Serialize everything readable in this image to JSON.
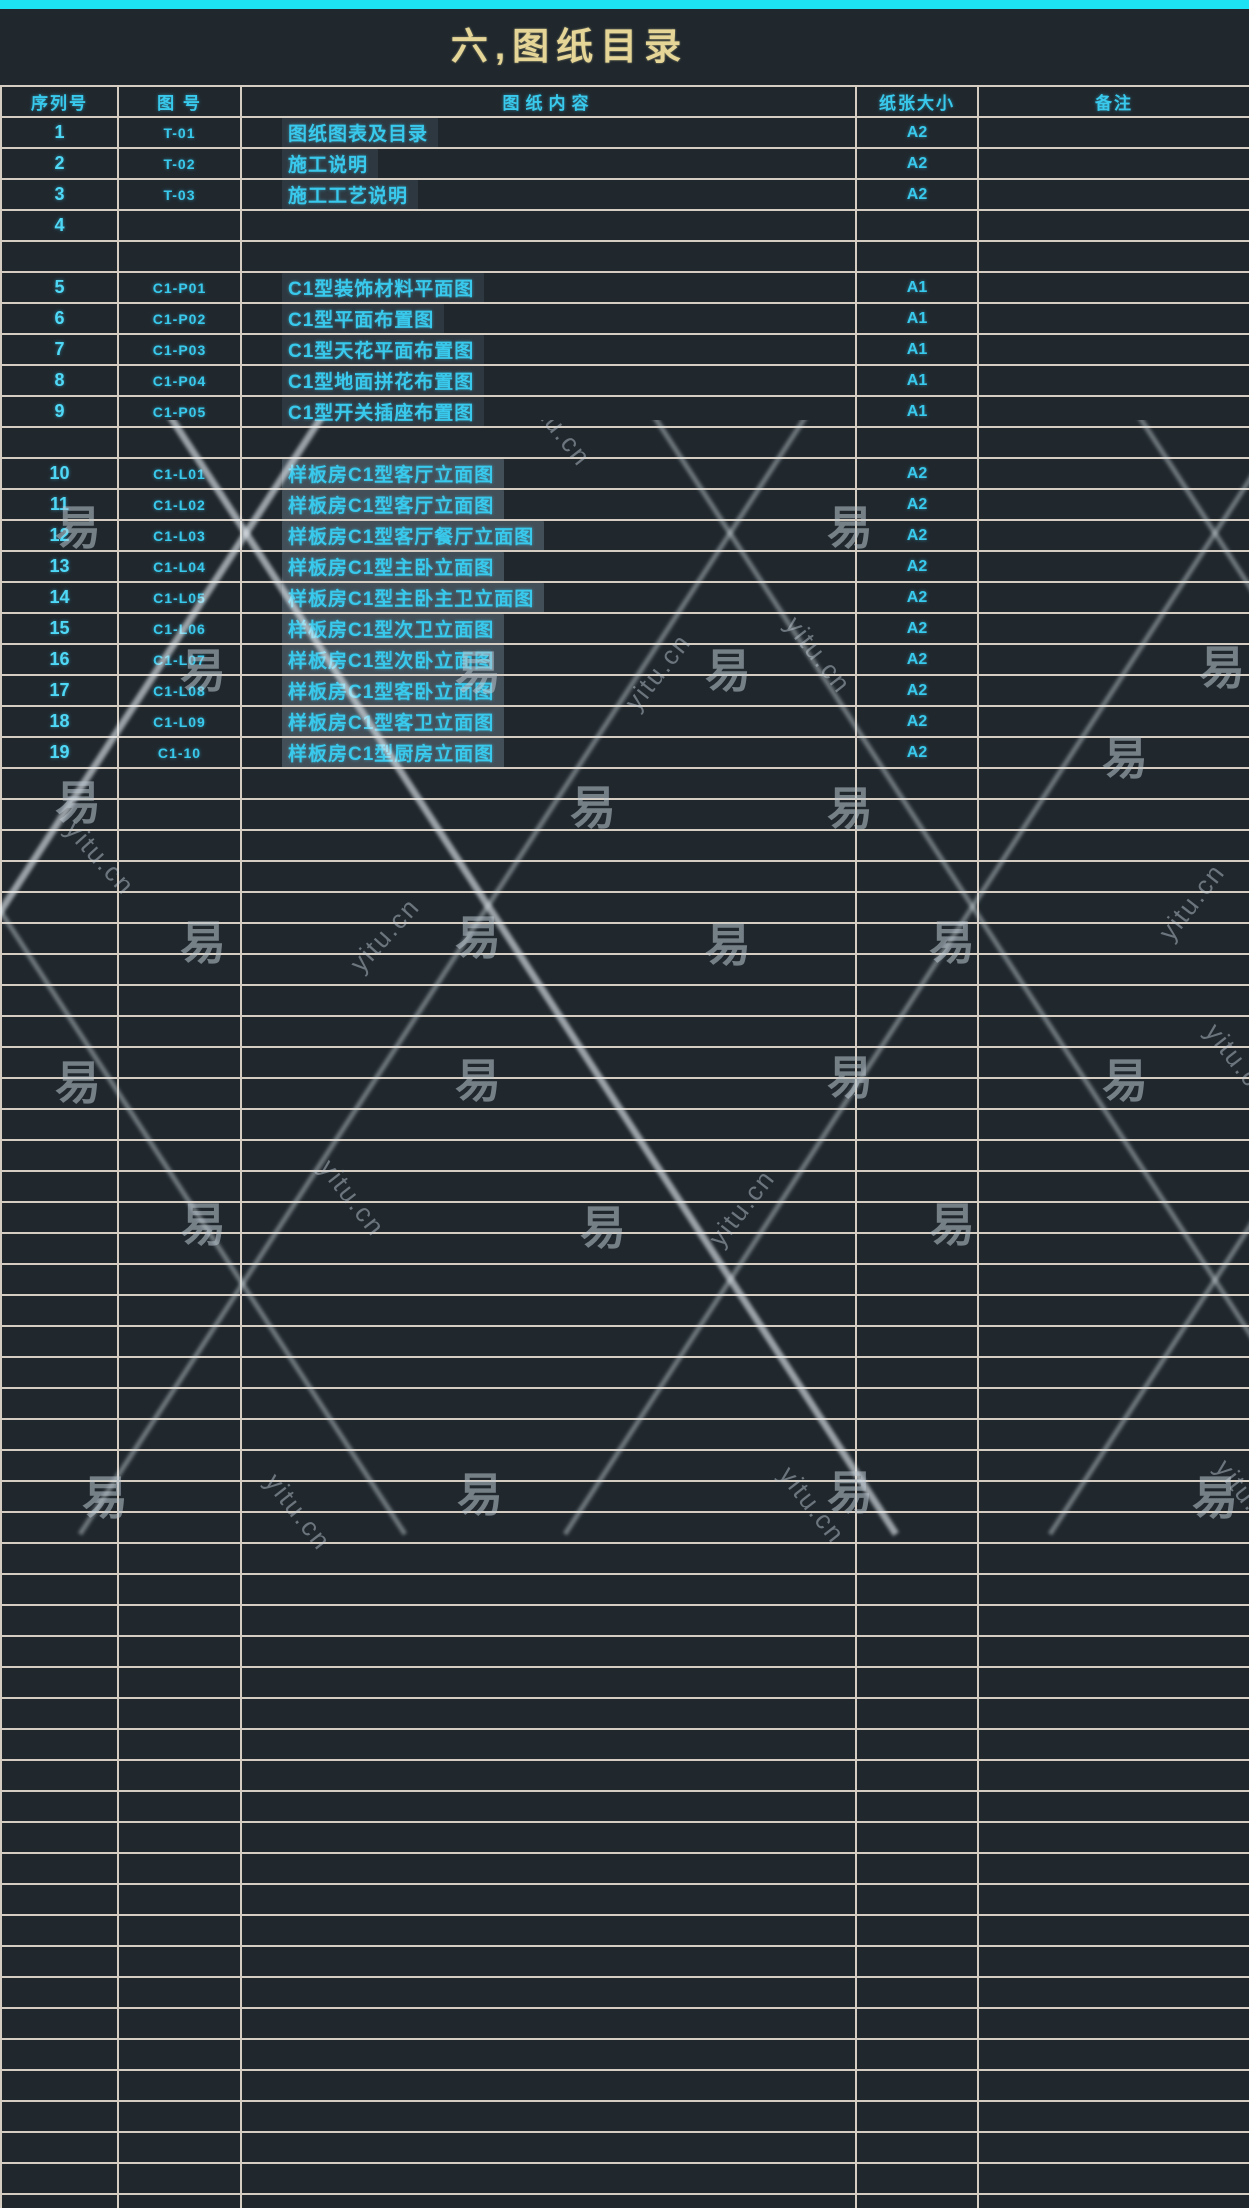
{
  "page": {
    "title": "六,图纸目录"
  },
  "table": {
    "headers": [
      "序列号",
      "图  号",
      "图纸内容",
      "纸张大小",
      "备注"
    ],
    "rows": [
      {
        "no": "1",
        "code": "T-01",
        "content": "图纸图表及目录",
        "size": "A2",
        "hl": "soft"
      },
      {
        "no": "2",
        "code": "T-02",
        "content": "施工说明",
        "size": "A2",
        "hl": "soft"
      },
      {
        "no": "3",
        "code": "T-03",
        "content": "施工工艺说明",
        "size": "A2",
        "hl": "soft"
      },
      {
        "no": "4",
        "code": "",
        "content": "",
        "size": "",
        "hl": ""
      },
      {
        "no": "",
        "code": "",
        "content": "",
        "size": "",
        "hl": ""
      },
      {
        "no": "5",
        "code": "C1-P01",
        "content": "C1型装饰材料平面图",
        "size": "A1",
        "hl": "soft"
      },
      {
        "no": "6",
        "code": "C1-P02",
        "content": "C1型平面布置图",
        "size": "A1",
        "hl": "soft"
      },
      {
        "no": "7",
        "code": "C1-P03",
        "content": "C1型天花平面布置图",
        "size": "A1",
        "hl": "soft"
      },
      {
        "no": "8",
        "code": "C1-P04",
        "content": "C1型地面拼花布置图",
        "size": "A1",
        "hl": "soft"
      },
      {
        "no": "9",
        "code": "C1-P05",
        "content": "C1型开关插座布置图",
        "size": "A1",
        "hl": "soft"
      },
      {
        "no": "",
        "code": "",
        "content": "",
        "size": "",
        "hl": ""
      },
      {
        "no": "10",
        "code": "C1-L01",
        "content": "样板房C1型客厅立面图",
        "size": "A2",
        "hl": "strong"
      },
      {
        "no": "11",
        "code": "C1-L02",
        "content": "样板房C1型客厅立面图",
        "size": "A2",
        "hl": "strong"
      },
      {
        "no": "12",
        "code": "C1-L03",
        "content": "样板房C1型客厅餐厅立面图",
        "size": "A2",
        "hl": "strong"
      },
      {
        "no": "13",
        "code": "C1-L04",
        "content": "样板房C1型主卧立面图",
        "size": "A2",
        "hl": "strong"
      },
      {
        "no": "14",
        "code": "C1-L05",
        "content": "样板房C1型主卧主卫立面图",
        "size": "A2",
        "hl": "strong"
      },
      {
        "no": "15",
        "code": "C1-L06",
        "content": "样板房C1型次卫立面图",
        "size": "A2",
        "hl": "strong"
      },
      {
        "no": "16",
        "code": "C1-L07",
        "content": "样板房C1型次卧立面图",
        "size": "A2",
        "hl": "strong"
      },
      {
        "no": "17",
        "code": "C1-L08",
        "content": "样板房C1型客卧立面图",
        "size": "A2",
        "hl": "strong"
      },
      {
        "no": "18",
        "code": "C1-L09",
        "content": "样板房C1型客卫立面图",
        "size": "A2",
        "hl": "strong"
      },
      {
        "no": "19",
        "code": "C1-10",
        "content": "样板房C1型厨房立面图",
        "size": "A2",
        "hl": "strong"
      }
    ],
    "empty_row_count": 47
  },
  "watermark": {
    "logo": "易图网",
    "char": "易",
    "domain": "yitu.cn",
    "char_positions": [
      [
        78,
        105
      ],
      [
        850,
        105
      ],
      [
        203,
        248
      ],
      [
        478,
        250
      ],
      [
        728,
        248
      ],
      [
        1222,
        245
      ],
      [
        78,
        380
      ],
      [
        593,
        385
      ],
      [
        850,
        386
      ],
      [
        1125,
        335
      ],
      [
        203,
        520
      ],
      [
        478,
        515
      ],
      [
        728,
        522
      ],
      [
        952,
        520
      ],
      [
        78,
        660
      ],
      [
        478,
        658
      ],
      [
        850,
        655
      ],
      [
        1125,
        658
      ],
      [
        203,
        802
      ],
      [
        603,
        805
      ],
      [
        952,
        802
      ],
      [
        105,
        1075
      ],
      [
        480,
        1072
      ],
      [
        850,
        1070
      ],
      [
        1215,
        1075
      ]
    ],
    "domain_positions": [
      [
        658,
        252,
        -52
      ],
      [
        818,
        235,
        52
      ],
      [
        558,
        8,
        52
      ],
      [
        100,
        438,
        48
      ],
      [
        385,
        515,
        -48
      ],
      [
        1192,
        482,
        -52
      ],
      [
        352,
        778,
        52
      ],
      [
        742,
        788,
        -52
      ],
      [
        1238,
        642,
        52
      ],
      [
        298,
        1092,
        52
      ],
      [
        812,
        1085,
        52
      ],
      [
        1248,
        1078,
        52
      ]
    ],
    "line_descending_x": [
      -360,
      130,
      615,
      1100,
      1585
    ],
    "line_ascending_x": [
      -130,
      355,
      840,
      1325,
      1810
    ],
    "bright_lines": [
      1,
      6
    ]
  },
  "colors": {
    "background": "#20282e",
    "top_bar": "#1ce2f4",
    "grid_line": "#d5ccc2",
    "text_cyan": "#38c9ec",
    "title_gold": "#e5d697"
  }
}
